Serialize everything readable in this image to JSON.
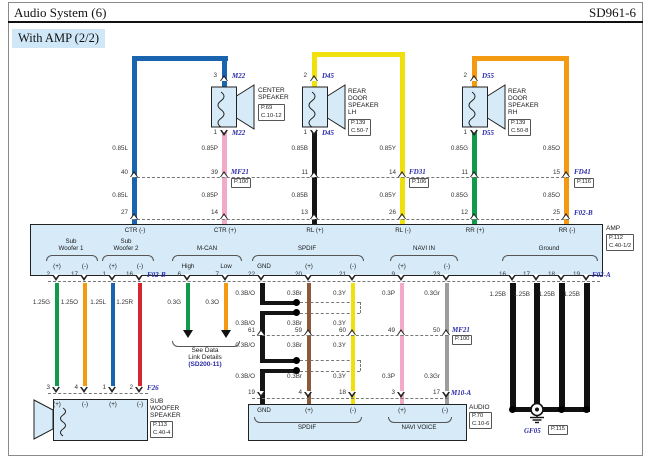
{
  "colors": {
    "wire_blue": "#1a63ae",
    "wire_pink": "#f3aac9",
    "wire_black": "#151515",
    "wire_yellow": "#f0e10c",
    "wire_green": "#119a49",
    "wire_orange": "#f39a12",
    "wire_red": "#d6272e",
    "wire_brown": "#8d5a39",
    "wire_gray": "#9d9d9d",
    "panel_fill": "#d6eaf7",
    "connector_label": "#2b2ba8"
  },
  "header": {
    "title": "Audio System (6)",
    "code": "SD961-6",
    "variant": "With AMP (2/2)"
  },
  "top": {
    "gauges": {
      "l": "0.85L",
      "p": "0.85P",
      "b": "0.85B",
      "y": "0.85Y",
      "g": "0.85G",
      "o": "0.85O"
    },
    "joint_pins": [
      "40",
      "39",
      "11",
      "14",
      "11",
      "15"
    ],
    "joints": {
      "mf21": {
        "name": "MF21",
        "page": "P.100"
      },
      "fd31": {
        "name": "FD31",
        "page": "P.106"
      },
      "fd41": {
        "name": "FD41",
        "page": "P.116"
      }
    }
  },
  "speakers": {
    "center": {
      "name1": "CENTER",
      "name2": "SPEAKER",
      "page": "P.69",
      "conn": "C.10-12",
      "connector": "M22",
      "pin_top": "3",
      "pin_bot": "1"
    },
    "rear_lh": {
      "name1": "REAR",
      "name2": "DOOR",
      "name3": "SPEAKER",
      "name4": "LH",
      "page": "P.139",
      "conn": "C.50-7",
      "connector": "D45",
      "pin_top": "2",
      "pin_bot": "1"
    },
    "rear_rh": {
      "name1": "REAR",
      "name2": "DOOR",
      "name3": "SPEAKER",
      "name4": "RH",
      "page": "P.139",
      "conn": "C.50-8",
      "connector": "D55",
      "pin_top": "2",
      "pin_bot": "1"
    }
  },
  "amp": {
    "name": "AMP",
    "page": "P.112",
    "conn": "C.40-1/2",
    "f02b": "F02-B",
    "f02a": "F02-A",
    "top_pins": [
      "27",
      "14",
      "13",
      "26",
      "12",
      "25"
    ],
    "top_terms": [
      "CTR (-)",
      "CTR (+)",
      "RL (+)",
      "RL (-)",
      "RR (+)",
      "RR (-)"
    ],
    "sw1": {
      "l1": "Sub",
      "l2": "Woofer 1",
      "t1": "(+)",
      "t2": "(-)",
      "p1": "2",
      "p2": "17"
    },
    "sw2": {
      "l1": "Sub",
      "l2": "Woofer 2",
      "t1": "(+)",
      "t2": "(-)",
      "p1": "1",
      "p2": "16"
    },
    "mcan": {
      "label": "M-CAN",
      "t1": "High",
      "t2": "Low",
      "p1": "6",
      "p2": "7"
    },
    "spdif": {
      "label": "SPDIF",
      "t1": "GND",
      "t2": "(+)",
      "t3": "(-)",
      "p1": "22",
      "p2": "20",
      "p3": "21"
    },
    "navi": {
      "label": "NAVI IN",
      "t1": "(+)",
      "t2": "(-)",
      "p1": "9",
      "p2": "23"
    },
    "ground": {
      "label": "Ground",
      "p1": "16",
      "p2": "17",
      "p3": "18",
      "p4": "19"
    }
  },
  "bottom": {
    "gauges": {
      "g125": "1.25G",
      "o125": "1.25O",
      "l125": "1.25L",
      "r125": "1.25R",
      "g03": "0.3G",
      "o03": "0.3O",
      "bo": "0.3B/O",
      "br": "0.3Br",
      "y03": "0.3Y",
      "p03": "0.3P",
      "gr": "0.3Gr",
      "b125": "1.25B"
    },
    "mf21": {
      "name": "MF21",
      "page": "P.100",
      "pins": [
        "61",
        "59",
        "60",
        "49",
        "50"
      ]
    },
    "m10a": {
      "name": "M10-A",
      "pins": [
        "19",
        "4",
        "18",
        "3",
        "17"
      ]
    },
    "datalink": {
      "l1": "See Data",
      "l2": "Link Details",
      "l3": "(SD200-11)"
    }
  },
  "subwoofer": {
    "name1": "SUB",
    "name2": "WOOFER",
    "name3": "SPEAKER",
    "page": "P.113",
    "conn": "C.40-4",
    "connector": "F26",
    "pins": [
      "3",
      "4",
      "1",
      "2"
    ],
    "terms": [
      "(+)",
      "(-)",
      "(+)",
      "(-)"
    ]
  },
  "audio": {
    "name": "AUDIO",
    "page": "P.70",
    "conn": "C.10-6",
    "terms": [
      "GND",
      "(+)",
      "(-)",
      "(+)",
      "(-)"
    ],
    "spdif": "SPDIF",
    "navi": "NAVI VOICE"
  },
  "ground_point": {
    "name": "GF05",
    "page": "P.115"
  }
}
